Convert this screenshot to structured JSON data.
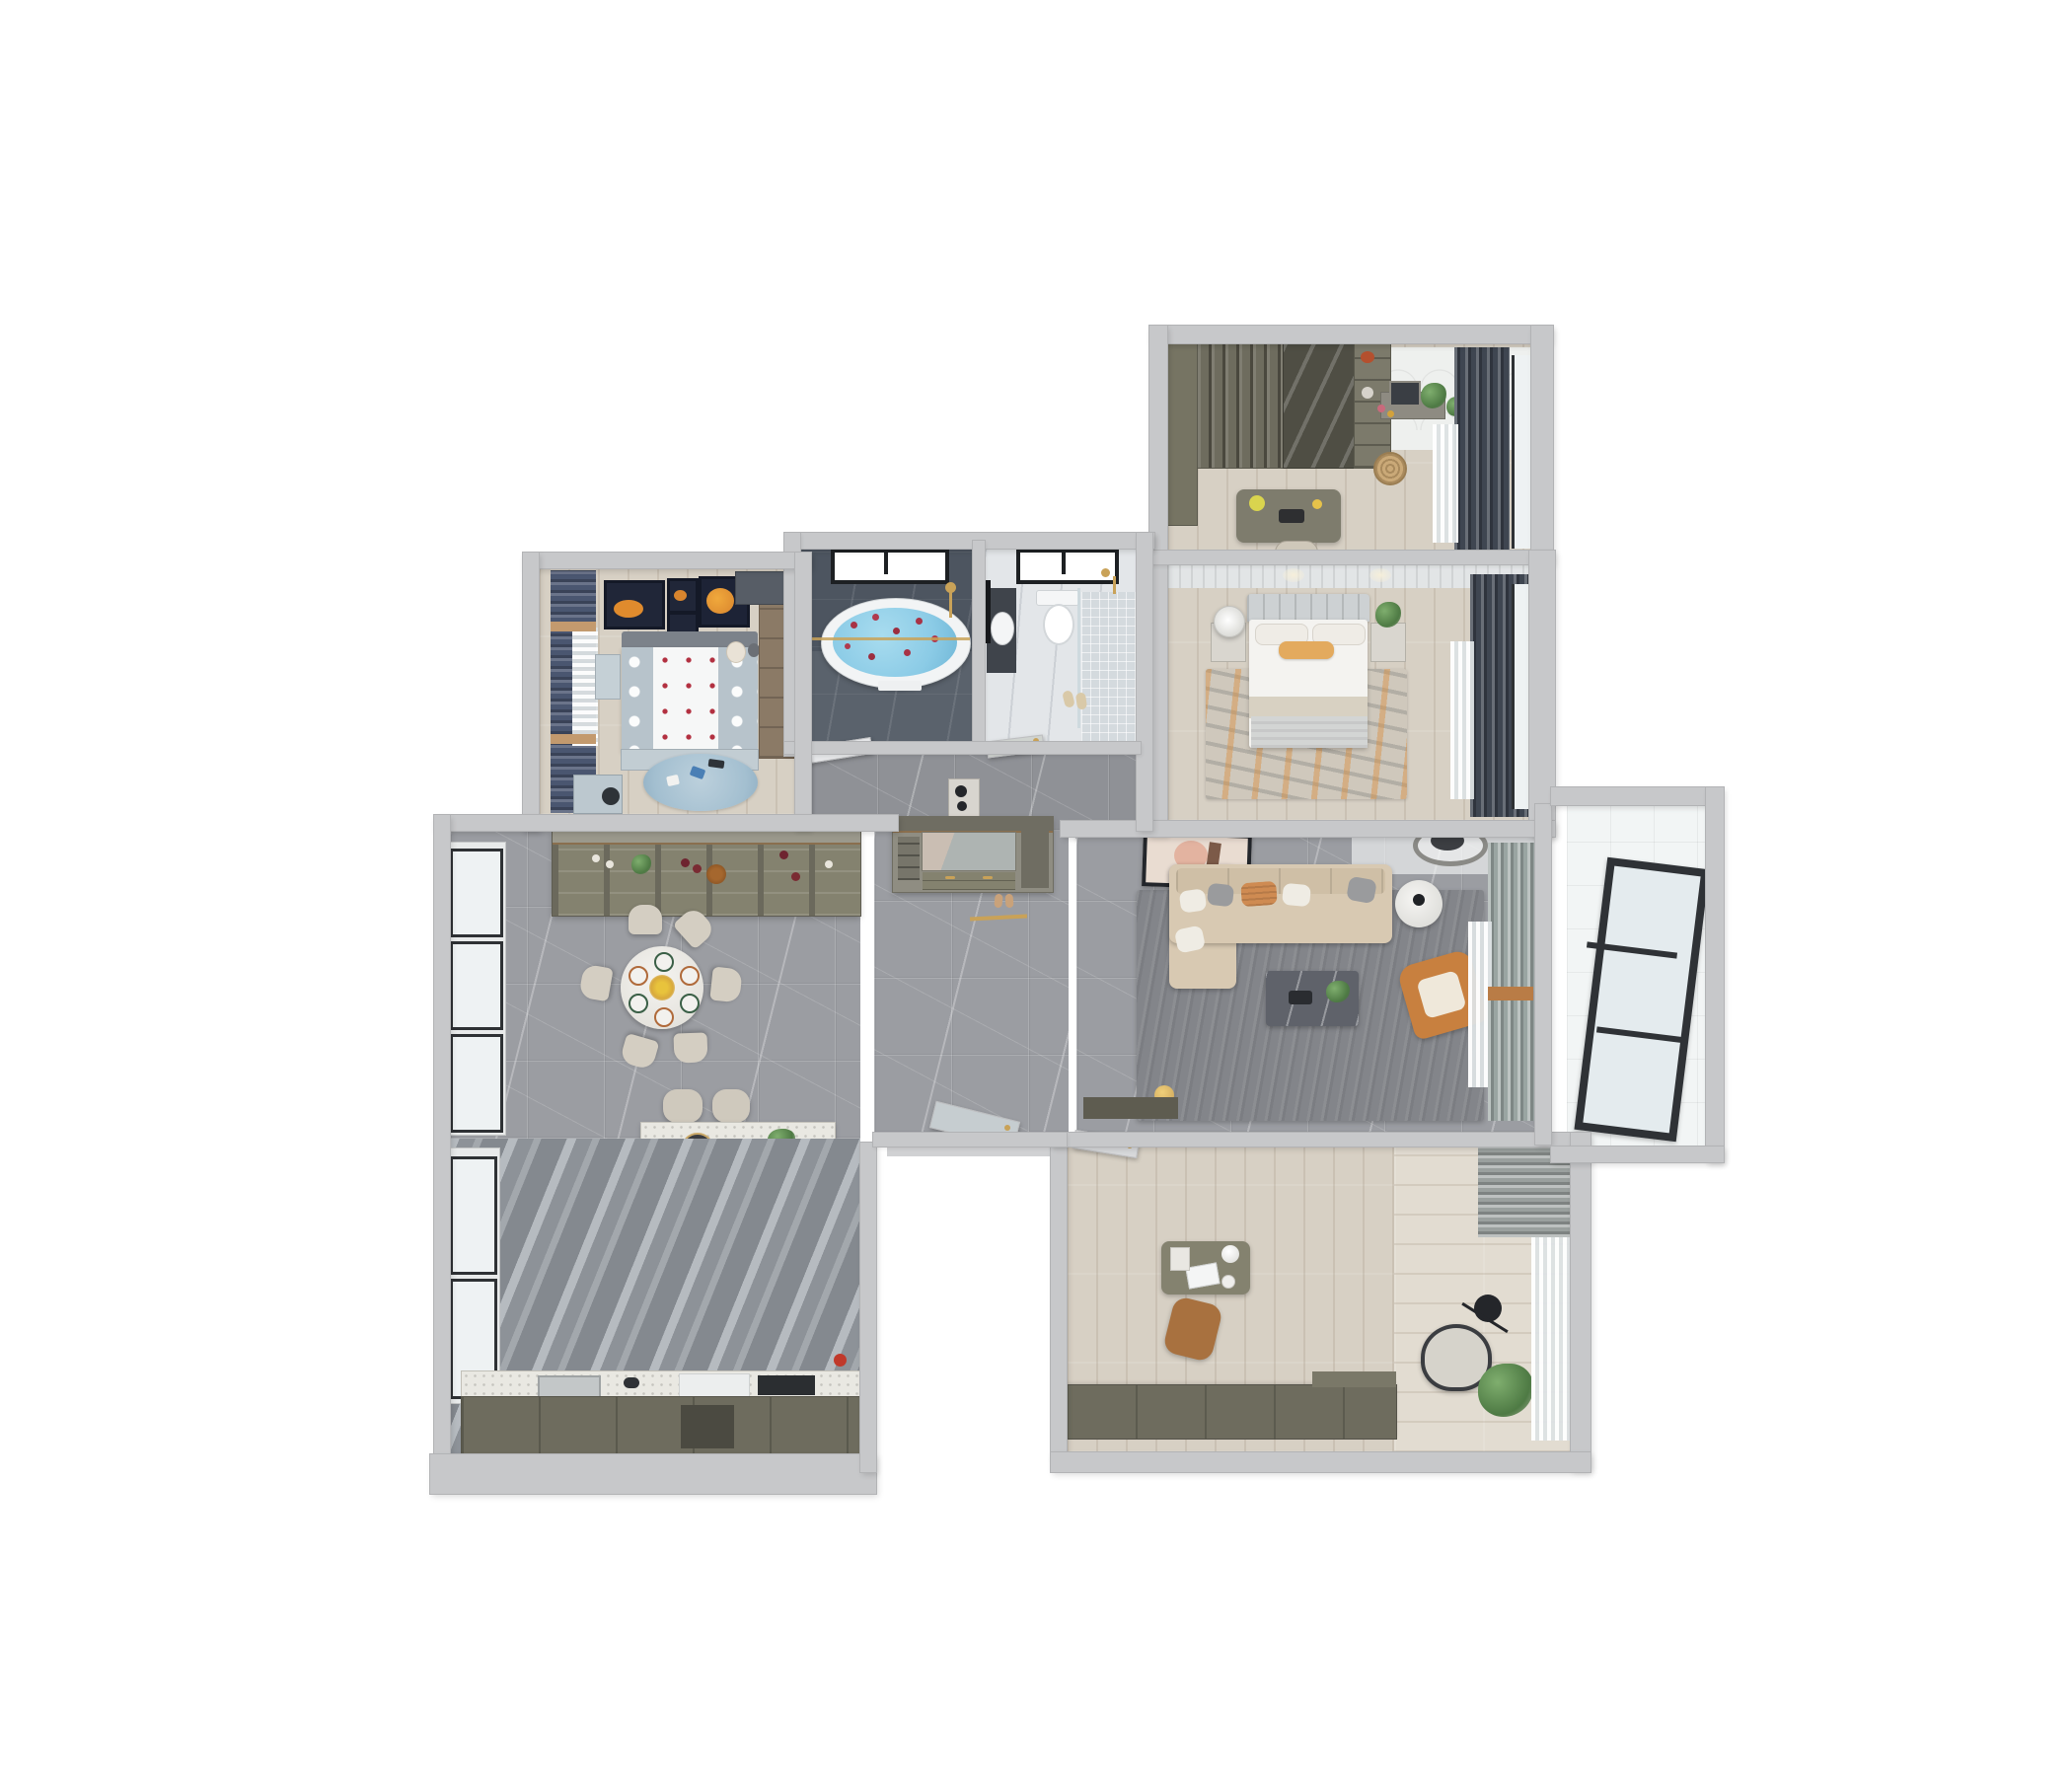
{
  "scene": {
    "type": "3d-floorplan-top-view",
    "description": "Top-down 3D render of a furnished three-bedroom apartment floor plan on a white background",
    "background": "#ffffff",
    "view": "axonometric top view, slight perspective tilt"
  },
  "palette": {
    "wall": "#c7c8ca",
    "wall_edge": "#b2b3b5",
    "marble_floor": "#9b9da2",
    "kitchen_stripe_tile": "#8d9298",
    "wood_floor": "#d7d0c4",
    "study_wood": "#ded7cb",
    "dark_bath": "#4d5560",
    "light_bath": "#e3e6e9",
    "tub_water": "#8bcbe6",
    "petal_red": "#a83346",
    "navy_curtain": "#4a5670",
    "slate_curtain": "#3f4651",
    "sage_curtain": "#9aa5a2",
    "sofa_beige": "#d8c9b2",
    "accent_orange": "#c8803f",
    "rug_gray": "#83858a",
    "master_rug_orange": "#d98f3f",
    "olive_cabinet": "#6e6c5e",
    "gold_hardware": "#c9a258",
    "kid_blue": "#b7c3cb",
    "art_orange": "#e08b2d"
  },
  "rooms": {
    "cloakroom_office": {
      "name": "Walk-in closet / office (top right)",
      "floor": "light wood",
      "furniture": [
        "wardrobe with hanging clothes",
        "glass-front wardrobe",
        "open shelf unit with bags",
        "writing desk with flowers and tray",
        "desk chair",
        "dressing table with mirror, perfumes and plants",
        "rattan basket",
        "scalloped tile dressing corner",
        "dark curtains with sheers over windows"
      ]
    },
    "master_bedroom": {
      "name": "Master bedroom",
      "floor": "light wood",
      "furniture": [
        "double bed with white duvet and orange lumbar pillow",
        "paneled headboard wall",
        "left nightstand with round white lamp",
        "right nightstand with plant",
        "distressed beige-orange area rug",
        "dark curtains and sheers along window wall",
        "door to foyer"
      ]
    },
    "master_bathroom": {
      "name": "Master bathroom (dark marble)",
      "floor": "dark slate marble",
      "furniture": [
        "freestanding oval bathtub with blue water and rose petals",
        "black framed window",
        "gold shower fixture",
        "gold glass partition rail",
        "white towel"
      ]
    },
    "guest_bathroom": {
      "name": "Guest bathroom",
      "floor": "light gray tile with mosaic shower zone",
      "furniture": [
        "wall-hung toilet",
        "dark vanity with white basin",
        "glass shower screen with gold fixtures",
        "black framed window",
        "slippers"
      ]
    },
    "kids_bedroom": {
      "name": "Kids bedroom",
      "floor": "light wood",
      "furniture": [
        "bed with polka-dot duvet and red-dotted runner",
        "teddy bear",
        "four space-themed wall art frames with orange planets",
        "navy curtains with sheer and wood pelmet",
        "study desk with black chair",
        "blue round play rug with toys",
        "wardrobe",
        "corner cabinet"
      ]
    },
    "hallway": {
      "name": "Hallway",
      "floor": "gray marble",
      "furniture": [
        "bathroom doors with gold handles",
        "console with black decor",
        "gold floor threshold strip"
      ]
    },
    "foyer": {
      "name": "Entry foyer",
      "floor": "gray marble",
      "furniture": [
        "built-in shoe cabinet with open niche, drawers and gold handles",
        "slippers",
        "entry door",
        "master bedroom door"
      ]
    },
    "dining_room": {
      "name": "Dining room",
      "floor": "gray veined marble",
      "furniture": [
        "round white dining table set for six",
        "gold flower centerpiece",
        "six upholstered chairs",
        "wine & display cabinet with bottles and glassware",
        "floor-to-ceiling windows"
      ]
    },
    "kitchen": {
      "name": "Kitchen",
      "floor": "striped gray marble tile",
      "furniture": [
        "terrazzo island bar with tray, plant and book",
        "two bar stools",
        "L-run dark cabinets with counter",
        "sink with black faucet",
        "white appliance",
        "dark cooktop",
        "red kettle",
        "side window"
      ]
    },
    "living_room": {
      "name": "Living room",
      "floor": "gray marble with large gray rug",
      "furniture": [
        "beige L-shaped sofa with white, gray and orange pillows",
        "dark marble coffee table with plant and tray",
        "orange accent armchair with cream cushion",
        "round white side table",
        "leaning abstract wall art",
        "double-ring ceiling light",
        "sage curtains with sheers",
        "gold table lamp"
      ]
    },
    "balcony": {
      "name": "Balcony (right)",
      "floor": "white tile",
      "furniture": [
        "large black-framed triple window leaning on wall"
      ]
    },
    "home_office": {
      "name": "Home office / guest room (bottom right)",
      "floor": "light wood planks, lighter balcony strip",
      "furniture": [
        "desk with white laptop, dome lamp and tray",
        "brown swivel chair",
        "gray lounge chair",
        "black arc floor lamp",
        "potted plant",
        "gray curtain and sheers",
        "long dark storage cabinet",
        "door to living room"
      ]
    },
    "entry_recess": {
      "name": "Entry recess (notch)",
      "furniture": [
        "open glazed entry door with gold handle",
        "door frame"
      ]
    }
  },
  "counts": {
    "rooms": 13,
    "bathrooms": 2,
    "bedrooms": 3
  }
}
